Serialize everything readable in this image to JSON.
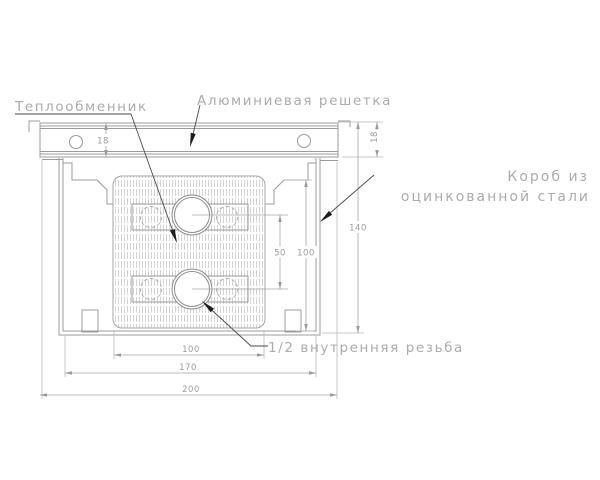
{
  "drawing": {
    "type": "technical-section-drawing",
    "subject": "in-floor convector cross-section",
    "labels": {
      "heat_exchanger": "Теплообменник",
      "grille": "Алюминиевая решетка",
      "box_line1": "Короб из",
      "box_line2": "оцинкованной стали",
      "thread": "1/2 внутренняя резьба"
    },
    "dimensions": {
      "grille_height_left": "18",
      "grille_height_right": "18",
      "total_height": "140",
      "inner_height": "100",
      "pipe_spacing": "50",
      "exchanger_width": "100",
      "box_width": "170",
      "grille_width": "200"
    },
    "colors": {
      "background": "#ffffff",
      "line": "#9b9b9b",
      "extension_line": "#b9b9b9",
      "hatch": "#c9c9c9",
      "label_text": "#ababab",
      "dim_text": "#9b9b9b",
      "leader_arrow": "#1c1c1c"
    }
  }
}
